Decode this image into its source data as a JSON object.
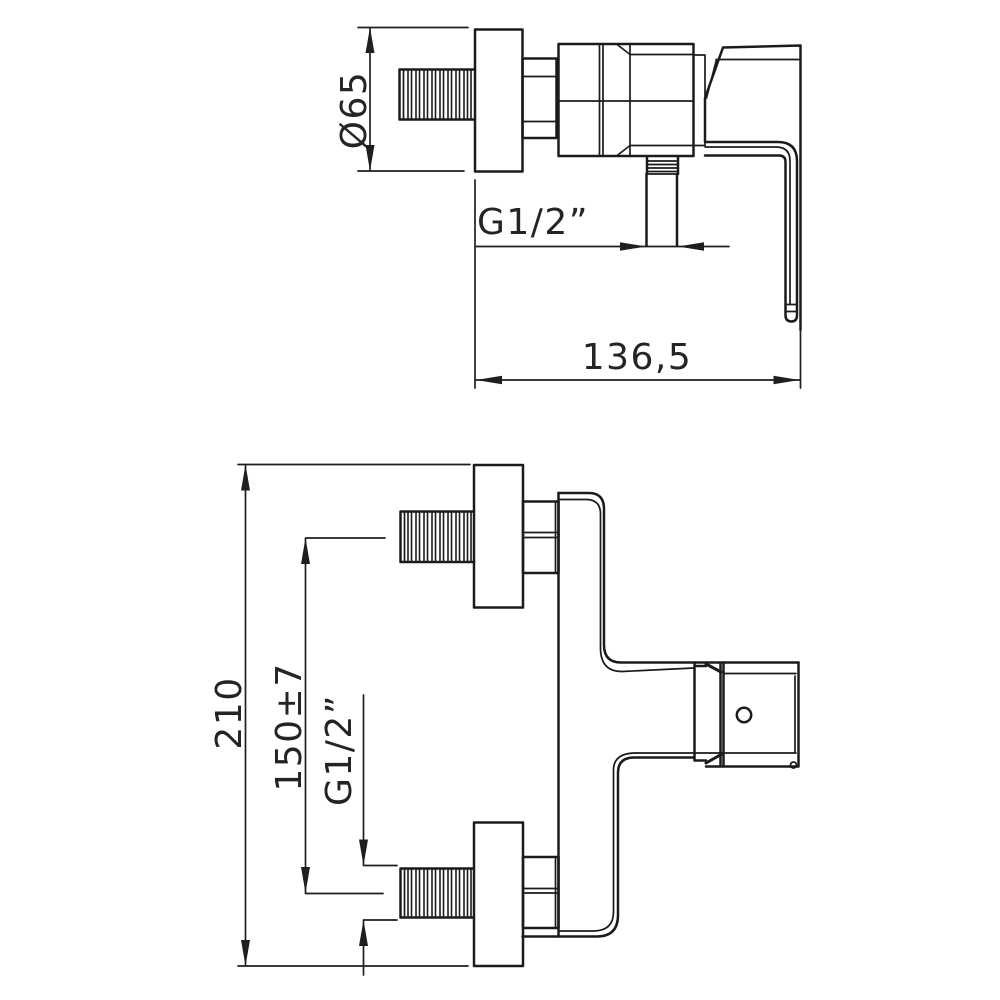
{
  "drawing": {
    "description": "Technical dimension drawing of a wall-mounted single-lever shower mixer tap, two orthographic views",
    "background_color": "#ffffff",
    "line_color": "#1b1b1b",
    "side_view": {
      "name": "side view",
      "dimensions": [
        {
          "id": "flange-diameter",
          "label": "Ø65"
        },
        {
          "id": "outlet-thread",
          "label": "G1/2”"
        },
        {
          "id": "overall-depth",
          "label": "136,5"
        }
      ]
    },
    "front_view": {
      "name": "front view",
      "dimensions": [
        {
          "id": "overall-length",
          "label": "210"
        },
        {
          "id": "inlet-spacing",
          "label": "150±7"
        },
        {
          "id": "inlet-thread",
          "label": "G1/2”"
        }
      ]
    }
  }
}
